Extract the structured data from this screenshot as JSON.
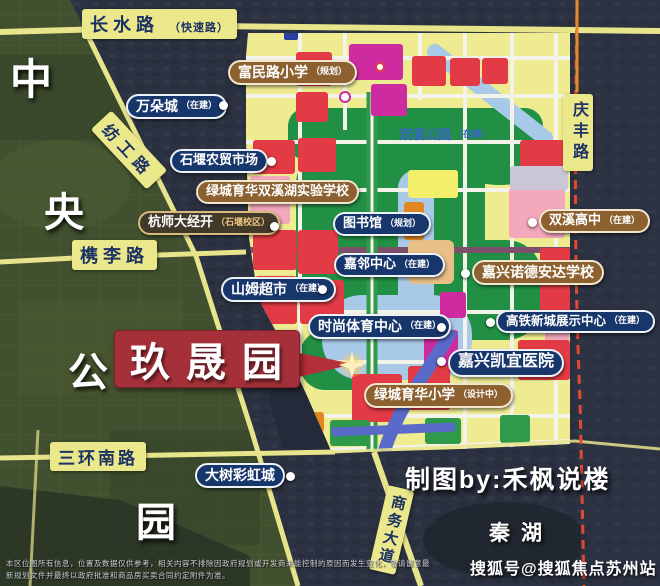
{
  "map": {
    "project": {
      "name": "玖晟园"
    },
    "roads": [
      {
        "id": "changshui",
        "label": "长水路",
        "suffix": "（快速路）"
      },
      {
        "id": "fanggong",
        "label": "纺工路",
        "suffix": ""
      },
      {
        "id": "zuili",
        "label": "槜李路",
        "suffix": ""
      },
      {
        "id": "qingfeng",
        "label": "庆丰路",
        "suffix": ""
      },
      {
        "id": "sanhuan",
        "label": "三环南路",
        "suffix": ""
      },
      {
        "id": "shangwu",
        "label": "商务大道",
        "suffix": ""
      }
    ],
    "district_chars": [
      "中",
      "央",
      "公",
      "园"
    ],
    "park_label": {
      "text": "双溪公园",
      "suffix": "（在建）"
    },
    "pois": [
      {
        "label": "万朵城",
        "suffix": "（在建）",
        "style": "navy"
      },
      {
        "label": "富民路小学",
        "suffix": "（规划）",
        "style": "brown"
      },
      {
        "label": "石堰农贸市场",
        "suffix": "",
        "style": "navy"
      },
      {
        "label": "绿城育华双溪湖实验学校",
        "suffix": "",
        "style": "brown"
      },
      {
        "label": "杭师大经开",
        "suffix": "（石堰校区）",
        "style": "dark"
      },
      {
        "label": "图书馆",
        "suffix": "（规划）",
        "style": "navy"
      },
      {
        "label": "双溪高中",
        "suffix": "（在建）",
        "style": "brown"
      },
      {
        "label": "嘉邻中心",
        "suffix": "（在建）",
        "style": "navy"
      },
      {
        "label": "嘉兴诺德安达学校",
        "suffix": "",
        "style": "brown"
      },
      {
        "label": "山姆超市",
        "suffix": "（在建）",
        "style": "navy"
      },
      {
        "label": "时尚体育中心",
        "suffix": "（在建）",
        "style": "navy"
      },
      {
        "label": "高铁新城展示中心",
        "suffix": "（在建）",
        "style": "navy"
      },
      {
        "label": "嘉兴凯宜医院",
        "suffix": "",
        "style": "navy"
      },
      {
        "label": "绿城育华小学",
        "suffix": "（设计中）",
        "style": "brown"
      },
      {
        "label": "大树彩虹城",
        "suffix": "",
        "style": "navy"
      }
    ],
    "lake_label": "秦湖",
    "credit": "制图by:禾枫说楼",
    "watermark": "搜狐号@搜狐焦点苏州站",
    "disclaimer": [
      "本区位图所有信息，位置及数据仅供参考，相关内容不排除因政府规划或开发商未能控制的原因而发生变化，敬请留意最",
      "新规划文件并最终以政府批准和商品房买卖合同约定附件为准。"
    ],
    "colors": {
      "project_red": "#a6303a",
      "label_navy": "#17366b",
      "label_brown": "#8d6030",
      "road_yellow": "#ebe78b",
      "boundary_red": "#e2492f",
      "park_green": "#219044",
      "parcel_red": "#e33b45",
      "parcel_magenta": "#cf2ba0",
      "water_blue": "#a9c9e9"
    }
  }
}
